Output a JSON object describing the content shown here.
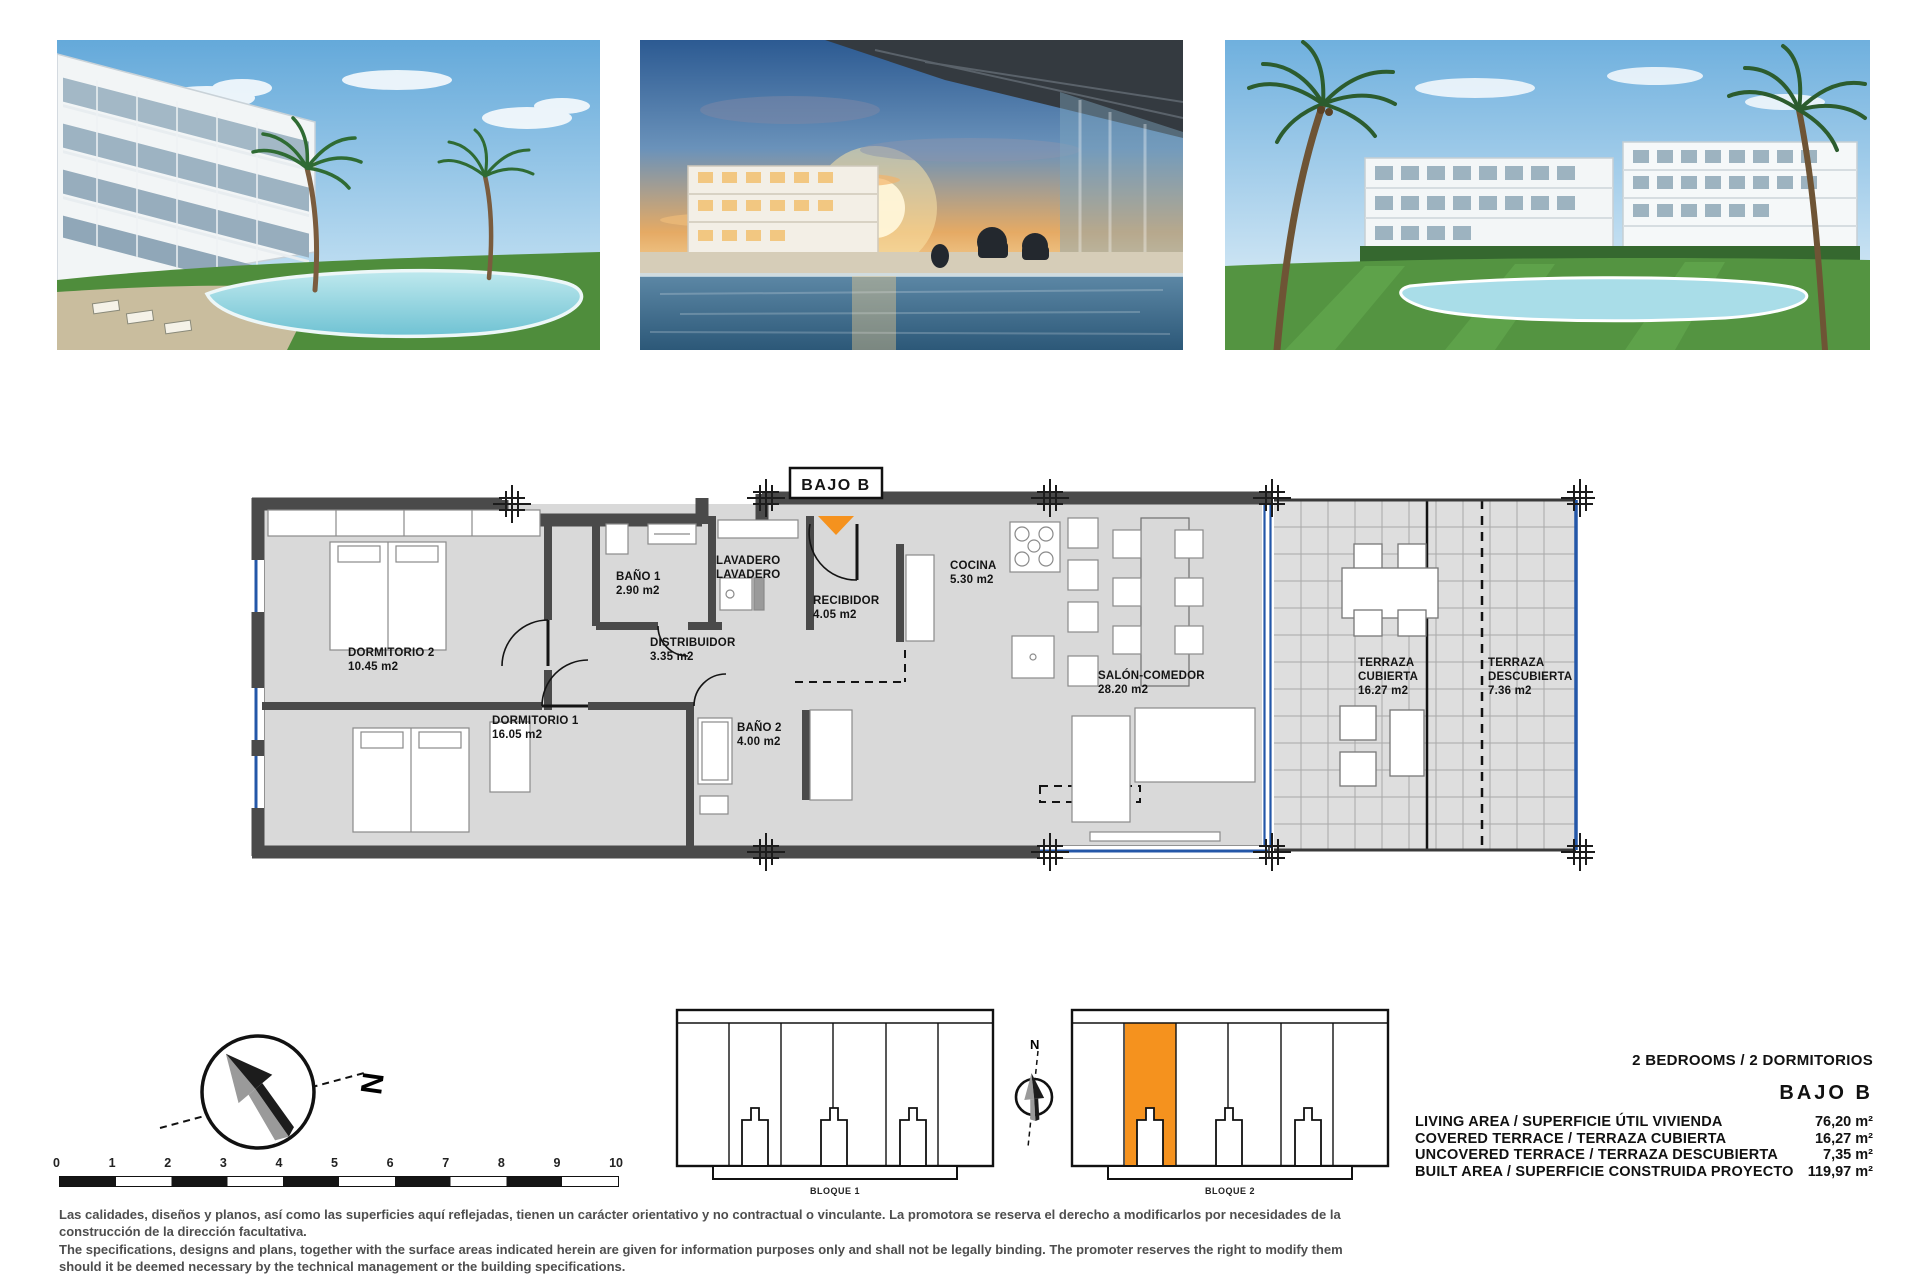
{
  "photos": [
    {
      "name": "pool-garden-render"
    },
    {
      "name": "terrace-sunset-render"
    },
    {
      "name": "buildings-pool-render"
    }
  ],
  "plan": {
    "unit_label": "BAJO B",
    "rooms": [
      {
        "id": "dormitorio-2",
        "lines": [
          "DORMITORIO 2",
          "10.45 m2"
        ]
      },
      {
        "id": "bano-1",
        "lines": [
          "BAÑO 1",
          "2.90 m2"
        ]
      },
      {
        "id": "lavadero",
        "lines": [
          "LAVADERO",
          "LAVADERO"
        ]
      },
      {
        "id": "recibidor",
        "lines": [
          "RECIBIDOR",
          "4.05 m2"
        ]
      },
      {
        "id": "cocina",
        "lines": [
          "COCINA",
          "5.30 m2"
        ]
      },
      {
        "id": "distribuidor",
        "lines": [
          "DISTRIBUIDOR",
          "3.35 m2"
        ]
      },
      {
        "id": "dormitorio-1",
        "lines": [
          "DORMITORIO 1",
          "16.05 m2"
        ]
      },
      {
        "id": "bano-2",
        "lines": [
          "BAÑO 2",
          "4.00 m2"
        ]
      },
      {
        "id": "salon-comedor",
        "lines": [
          "SALÓN-COMEDOR",
          "28.20 m2"
        ]
      },
      {
        "id": "terraza-cubierta",
        "lines": [
          "TERRAZA",
          "CUBIERTA",
          "16.27 m2"
        ]
      },
      {
        "id": "terraza-descubierta",
        "lines": [
          "TERRAZA",
          "DESCUBIERTA",
          "7.36 m2"
        ]
      }
    ]
  },
  "compass": {
    "north_label": "N"
  },
  "site_compass": {
    "north_label": "N"
  },
  "scale_bar": {
    "ticks": [
      "0",
      "1",
      "2",
      "3",
      "4",
      "5",
      "6",
      "7",
      "8",
      "9",
      "10"
    ]
  },
  "blocks": [
    {
      "label": "BLOQUE 1"
    },
    {
      "label": "BLOQUE 2"
    }
  ],
  "summary": {
    "bedrooms_line": "2 BEDROOMS / 2 DORMITORIOS",
    "unit_name": "BAJO B",
    "rows": [
      {
        "label": "LIVING AREA / SUPERFICIE ÚTIL VIVIENDA",
        "value": "76,20 m²"
      },
      {
        "label": "COVERED TERRACE / TERRAZA CUBIERTA",
        "value": "16,27 m²"
      },
      {
        "label": "UNCOVERED TERRACE / TERRAZA DESCUBIERTA",
        "value": "7,35 m²"
      },
      {
        "label": "BUILT AREA / SUPERFICIE CONSTRUIDA PROYECTO",
        "value": "119,97 m²"
      }
    ]
  },
  "disclaimer": {
    "es": "Las calidades, diseños y planos, así como las superficies aquí reflejadas, tienen un carácter orientativo y no contractual o vinculante. La promotora se reserva el derecho a modificarlos por necesidades de la construcción de la dirección facultativa.",
    "en": "The specifications, designs and plans, together with the surface areas indicated herein are given for information purposes only and shall not be legally binding. The promoter reserves the right to modify them should it be deemed necessary by the technical management or the building specifications."
  },
  "colors": {
    "accent_orange": "#f5921e",
    "wall_gray": "#4a4a4a",
    "floor_gray": "#d9d9d9",
    "glazing_blue": "#2457a8"
  }
}
